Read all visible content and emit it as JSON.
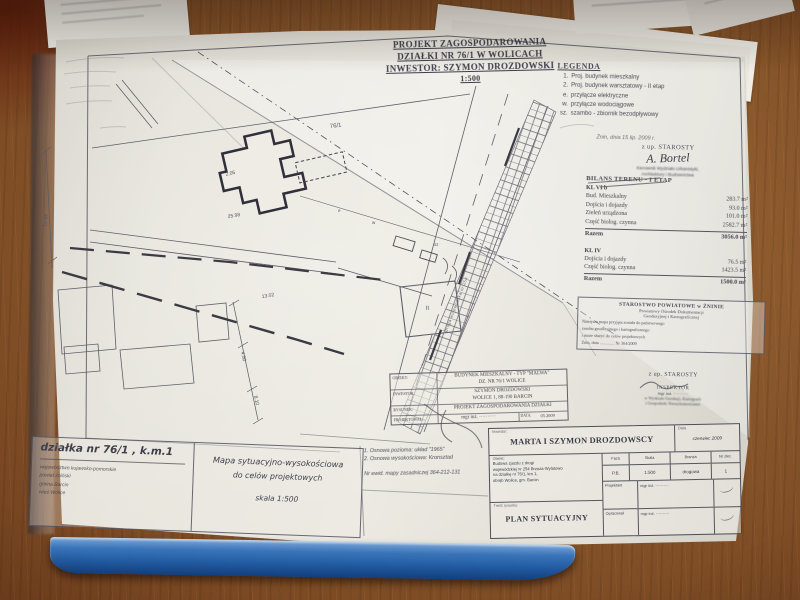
{
  "photo": {
    "desk_color": "#7f4e26",
    "binder_blue": "#2e66ac",
    "paper": "#e6e4db"
  },
  "title_block": {
    "line1": "PROJEKT ZAGOSPODAROWANIA",
    "line2": "DZIAŁKI NR 76/1 W WOLICACH",
    "line3": "INWESTOR: SZYMON DROZDOWSKI",
    "scale": "1:500"
  },
  "legend": {
    "title": "LEGENDA",
    "items": [
      {
        "key": "1.",
        "label": "Proj. budynek mieszkalny"
      },
      {
        "key": "2.",
        "label": "Proj. budynek warsztatowy - II etap"
      },
      {
        "key": "e.",
        "label": "przyłącze elektryczne"
      },
      {
        "key": "w.",
        "label": "przyłącze wodociągowe"
      },
      {
        "key": "sz.",
        "label": "szambo - zbiornik bezodpływowy"
      }
    ]
  },
  "approval": {
    "date": "Żnin, dnia 15 lip. 2009 r.",
    "zup": "z up. STAROSTY",
    "signature": "A. Bortel",
    "title1": "Kierownik Wydziału Urbanistyki,",
    "title2": "Architektury i Budownictwa"
  },
  "bilans": {
    "title": "BILANS TERENU - I ETAP",
    "s1_header": "KL VI b",
    "s1_rows": [
      {
        "label": "Bud. Mieszkalny",
        "value": "283.7 m²"
      },
      {
        "label": "Dojścia i dojazdy",
        "value": "93.0 m²"
      },
      {
        "label": "Zieleń urządzona",
        "value": "101.0 m²"
      },
      {
        "label": "Część biolog. czynna",
        "value": "2582.7 m²"
      }
    ],
    "s1_total_label": "Razem",
    "s1_total": "3056.0 m²",
    "s2_header": "KL IV",
    "s2_rows": [
      {
        "label": "Dojścia i dojazdy",
        "value": "76.5 m²"
      },
      {
        "label": "Część biolog. czynna",
        "value": "1423.5 m²"
      }
    ],
    "s2_total_label": "Razem",
    "s2_total": "1500.0 m²"
  },
  "cert": {
    "head1": "STAROSTWO POWIATOWE w ŻNINIE",
    "head2": "Powiatowy Ośrodek Dokumentacji",
    "head3": "Geodezyjnej i Kartograficznej",
    "body1": "Niniejsza mapa przyjęta została do państwowego",
    "body2": "zasobu geodezyjnego i kartograficznego",
    "body3": "i może służyć do celów projektowych",
    "body4": "Żnin, dnia ..............   Nr 364/2009",
    "zup": "z up. STAROSTY",
    "insp": "INSPEKTOR",
    "name": "mgr inż. ··········",
    "dept1": "w Wydziale Geodezji, Kartografii",
    "dept2": "i Gospodarki Nieruchomościami"
  },
  "mini_block": {
    "obiekt_label": "OBIEKT:",
    "obiekt1": "BUDYNEK MIESZKALNY - TYP \"MALWA\"",
    "obiekt2": "DZ. NR 76/1  WOLICE",
    "inwestor_label": "INWESTOR:",
    "inwestor1": "SZYMON DROZDOWSKI",
    "inwestor2": "WOLICE 1, 88-190 BARCIN",
    "rysunek_label": "RYSUNEK:",
    "rysunek1": "PROJEKT ZAGOSPODAROWANIA DZIAŁKI",
    "proj_label": "PROJEKTOWAŁ:",
    "proj_value": "mgr inż. ··········",
    "data_label": "DATA:",
    "data_value": "05.2009"
  },
  "notes": {
    "l1": "1. Osnowa pozioma: układ \"1965\"",
    "l2": "2. Osnowa wysokościowa: Kronsztad",
    "l3": "Nr ewid. mapy zasadniczej 364-212-131"
  },
  "plot_box": {
    "title": "działka nr 76/1 , k.m.1",
    "admin1": "województwo kujawsko-pomorskie",
    "admin2": "powiat żniński",
    "admin3": "gmina Barcin",
    "admin4": "wieś Wolice"
  },
  "map_box": {
    "l1": "Mapa sytuacyjno-wysokościowa",
    "l2": "do celów projektowych",
    "l3": "skala 1:500"
  },
  "table": {
    "inwestor_label": "Inwestor:",
    "inwestor": "MARTA I SZYMON DROZDOWSCY",
    "data_label": "Data",
    "data": "czerwiec 2009",
    "obiekt_label": "Obiekt:",
    "obiekt1": "Budowa zjazdu z drogi",
    "obiekt2": "wojewódzkiej nr 254 Brzoza-Wylatowo",
    "obiekt3": "na działkę nr 76/1, km 1,",
    "obiekt4": "obręb Wolice, gm. Barcin",
    "col1_h": "Faza",
    "col1_v": "P.B.",
    "col2_h": "Skala",
    "col2_v": "1:500",
    "col3_h": "Branża",
    "col3_v": "drogowa",
    "col4_h": "Nr zlec.",
    "col4_v": "1",
    "tresc_label": "Treść rysunku:",
    "tresc": "PLAN SYTUACYJNY",
    "projektant_label": "Projektant",
    "projektant": "mgr inż. ··········",
    "opracowal_label": "Opracował",
    "opracowal": "mgr inż. ··········"
  },
  "drawing": {
    "b2": "II",
    "road": "droga wojewódzka nr 254",
    "parcel": "76/1",
    "d1": "2.05",
    "d2": "25.98",
    "d3": "13.02",
    "d4": "4.50",
    "d5": "8.10",
    "d6": "49.01",
    "sz": "sz",
    "w": "w",
    "e": "e"
  }
}
